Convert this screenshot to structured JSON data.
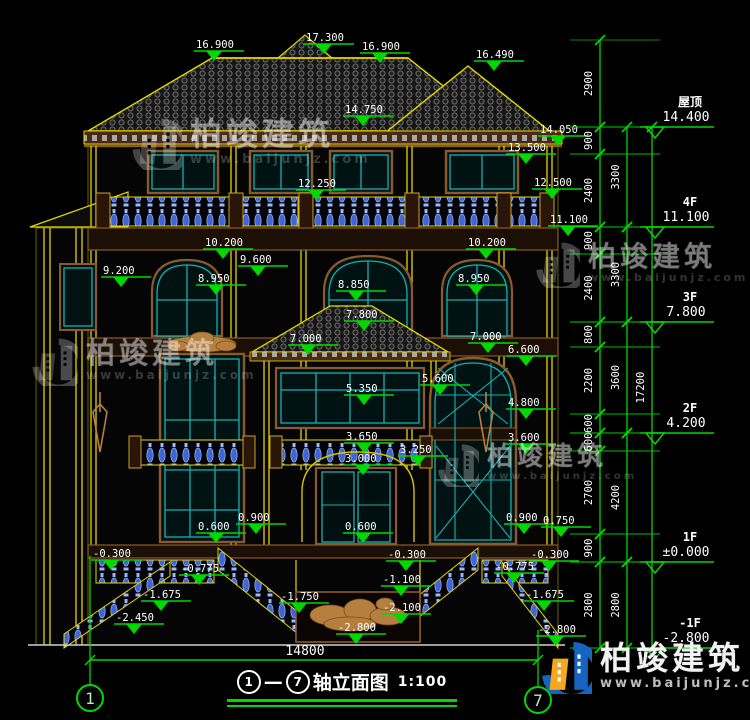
{
  "title": {
    "axis_from": "1",
    "axis_to": "7",
    "name": "轴立面图",
    "scale": "1:100"
  },
  "bottom_dimension": "14800",
  "axis_bubbles": [
    {
      "label": "1",
      "x": 90,
      "y": 698
    },
    {
      "label": "7",
      "x": 538,
      "y": 700
    }
  ],
  "colors": {
    "dim_green": "#00d800",
    "text_white": "#ffffff",
    "line_yellow": "#e6d800",
    "teal": "#19b0b0",
    "baluster_blue": "#3f66d4",
    "brown": "#8a5a2b",
    "logo_blue": "#1565c0",
    "logo_orange": "#f5a81c"
  },
  "facade_levels": [
    {
      "value": "16.900",
      "x": 196,
      "y": 38
    },
    {
      "value": "17.300",
      "x": 306,
      "y": 31
    },
    {
      "value": "16.900",
      "x": 362,
      "y": 40
    },
    {
      "value": "16.490",
      "x": 476,
      "y": 48
    },
    {
      "value": "14.750",
      "x": 345,
      "y": 103
    },
    {
      "value": "14.050",
      "x": 540,
      "y": 123
    },
    {
      "value": "13.500",
      "x": 508,
      "y": 141
    },
    {
      "value": "12.500",
      "x": 534,
      "y": 176
    },
    {
      "value": "12.250",
      "x": 298,
      "y": 177
    },
    {
      "value": "11.100",
      "x": 550,
      "y": 213
    },
    {
      "value": "10.200",
      "x": 205,
      "y": 236
    },
    {
      "value": "10.200",
      "x": 468,
      "y": 236
    },
    {
      "value": "9.600",
      "x": 240,
      "y": 253
    },
    {
      "value": "9.200",
      "x": 103,
      "y": 264
    },
    {
      "value": "8.950",
      "x": 198,
      "y": 272
    },
    {
      "value": "8.850",
      "x": 338,
      "y": 278
    },
    {
      "value": "8.950",
      "x": 458,
      "y": 272
    },
    {
      "value": "7.800",
      "x": 346,
      "y": 308
    },
    {
      "value": "7.000",
      "x": 290,
      "y": 332
    },
    {
      "value": "7.000",
      "x": 470,
      "y": 330
    },
    {
      "value": "6.600",
      "x": 508,
      "y": 343
    },
    {
      "value": "5.600",
      "x": 422,
      "y": 372
    },
    {
      "value": "5.350",
      "x": 346,
      "y": 382
    },
    {
      "value": "4.800",
      "x": 508,
      "y": 396
    },
    {
      "value": "3.650",
      "x": 346,
      "y": 430
    },
    {
      "value": "3.600",
      "x": 508,
      "y": 431
    },
    {
      "value": "3.250",
      "x": 400,
      "y": 443
    },
    {
      "value": "3.000",
      "x": 345,
      "y": 452
    },
    {
      "value": "0.600",
      "x": 198,
      "y": 520
    },
    {
      "value": "0.900",
      "x": 238,
      "y": 511
    },
    {
      "value": "0.600",
      "x": 345,
      "y": 520
    },
    {
      "value": "0.900",
      "x": 506,
      "y": 511
    },
    {
      "value": "0.750",
      "x": 543,
      "y": 514
    },
    {
      "value": "-0.300",
      "x": 93,
      "y": 547
    },
    {
      "value": "-0.300",
      "x": 388,
      "y": 548
    },
    {
      "value": "-0.300",
      "x": 531,
      "y": 548
    },
    {
      "value": "-0.775",
      "x": 181,
      "y": 562
    },
    {
      "value": "-0.775",
      "x": 496,
      "y": 560
    },
    {
      "value": "-1.100",
      "x": 383,
      "y": 573
    },
    {
      "value": "-1.675",
      "x": 143,
      "y": 588
    },
    {
      "value": "-1.675",
      "x": 526,
      "y": 588
    },
    {
      "value": "-1.750",
      "x": 281,
      "y": 590
    },
    {
      "value": "-2.100",
      "x": 383,
      "y": 601
    },
    {
      "value": "-2.450",
      "x": 116,
      "y": 611
    },
    {
      "value": "-2.800",
      "x": 338,
      "y": 621
    },
    {
      "value": "-2.800",
      "x": 538,
      "y": 623
    }
  ],
  "right_panel": {
    "chain1": {
      "x": 600,
      "label_x": 592,
      "segments": [
        {
          "label": "2900",
          "y1": 40,
          "y2": 127
        },
        {
          "label": "900",
          "y1": 127,
          "y2": 154
        },
        {
          "label": "2400",
          "y1": 154,
          "y2": 227
        },
        {
          "label": "900",
          "y1": 227,
          "y2": 254
        },
        {
          "label": "2400",
          "y1": 254,
          "y2": 322
        },
        {
          "label": "800",
          "y1": 322,
          "y2": 347
        },
        {
          "label": "2200",
          "y1": 347,
          "y2": 414
        },
        {
          "label": "600",
          "y1": 414,
          "y2": 433
        },
        {
          "label": "600",
          "y1": 433,
          "y2": 451
        },
        {
          "label": "2700",
          "y1": 451,
          "y2": 534
        },
        {
          "label": "900",
          "y1": 534,
          "y2": 562
        },
        {
          "label": "2800",
          "y1": 562,
          "y2": 648
        }
      ]
    },
    "chain2": {
      "x": 627,
      "label_x": 619,
      "segments": [
        {
          "label": "3300",
          "y1": 127,
          "y2": 227
        },
        {
          "label": "3300",
          "y1": 227,
          "y2": 322
        },
        {
          "label": "3600",
          "y1": 322,
          "y2": 433
        },
        {
          "label": "4200",
          "y1": 433,
          "y2": 562
        },
        {
          "label": "2800",
          "y1": 562,
          "y2": 648
        }
      ]
    },
    "chain3": {
      "x": 652,
      "label_x": 644,
      "segments": [
        {
          "label": "17200",
          "y1": 127,
          "y2": 648
        }
      ]
    },
    "floor_markers": [
      {
        "name": "屋顶",
        "value": "14.400",
        "y": 127
      },
      {
        "name": "4F",
        "value": "11.100",
        "y": 227
      },
      {
        "name": "3F",
        "value": "7.800",
        "y": 322
      },
      {
        "name": "2F",
        "value": "4.200",
        "y": 433
      },
      {
        "name": "1F",
        "value": "±0.000",
        "y": 562
      },
      {
        "name": "-1F",
        "value": "-2.800",
        "y": 648
      }
    ]
  },
  "watermark": {
    "name": "柏竣建筑",
    "url": "www.baijunjz.com",
    "instances": [
      {
        "x": 130,
        "y": 118,
        "s": 1.0,
        "bright": false
      },
      {
        "x": 30,
        "y": 338,
        "s": 0.92,
        "bright": false
      },
      {
        "x": 534,
        "y": 242,
        "s": 0.88,
        "bright": false
      },
      {
        "x": 436,
        "y": 444,
        "s": 0.82,
        "bright": false
      },
      {
        "x": 540,
        "y": 642,
        "s": 1.0,
        "bright": true
      }
    ]
  }
}
